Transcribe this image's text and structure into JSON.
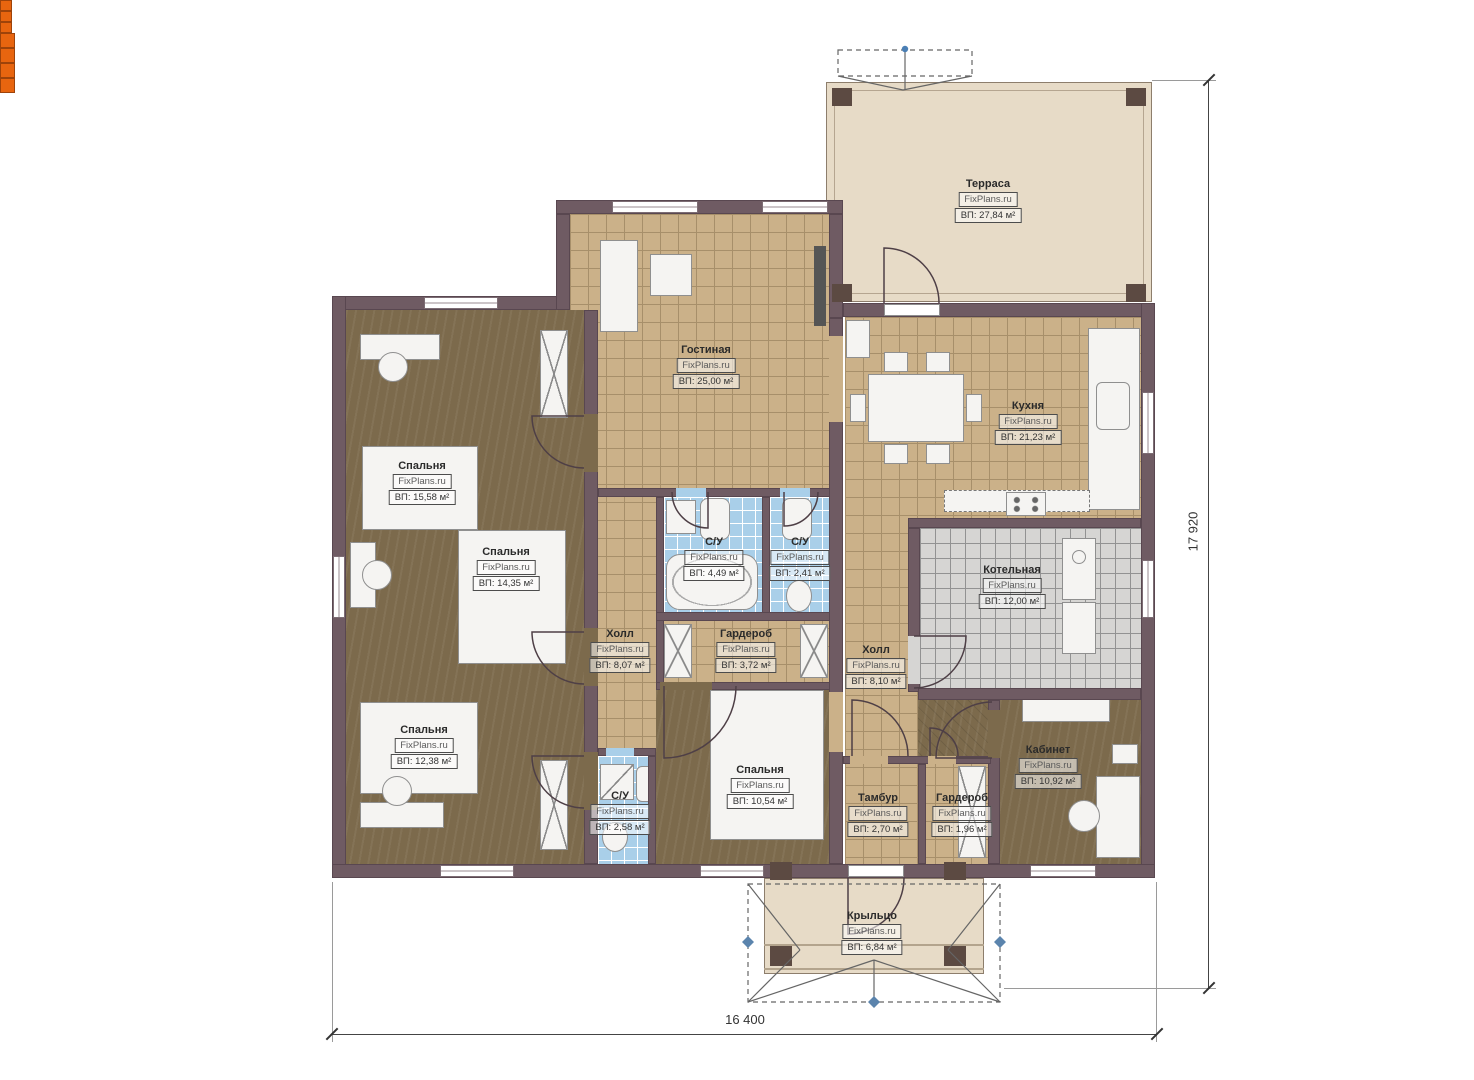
{
  "plan": {
    "brand": "FixPlans.ru",
    "dims": {
      "width": "16 400",
      "height": "17 920"
    },
    "rooms": [
      {
        "name": "Терраса",
        "area": "ВП: 27,84 м²"
      },
      {
        "name": "Гостиная",
        "area": "ВП: 25,00 м²"
      },
      {
        "name": "Кухня",
        "area": "ВП: 21,23 м²"
      },
      {
        "name": "Спальня",
        "area": "ВП: 15,58 м²"
      },
      {
        "name": "Спальня",
        "area": "ВП: 14,35 м²"
      },
      {
        "name": "С/У",
        "area": "ВП: 4,49 м²"
      },
      {
        "name": "С/У",
        "area": "ВП: 2,41 м²"
      },
      {
        "name": "Котельная",
        "area": "ВП: 12,00 м²"
      },
      {
        "name": "Холл",
        "area": "ВП: 8,07 м²"
      },
      {
        "name": "Гардероб",
        "area": "ВП: 3,72 м²"
      },
      {
        "name": "Холл",
        "area": "ВП: 8,10 м²"
      },
      {
        "name": "Спальня",
        "area": "ВП: 12,38 м²"
      },
      {
        "name": "Кабинет",
        "area": "ВП: 10,92 м²"
      },
      {
        "name": "С/У",
        "area": "ВП: 2,58 м²"
      },
      {
        "name": "Спальня",
        "area": "ВП: 10,54 м²"
      },
      {
        "name": "Тамбур",
        "area": "ВП: 2,70 м²"
      },
      {
        "name": "Гардероб",
        "area": "ВП: 1,96 м²"
      },
      {
        "name": "Крыльцо",
        "area": "ВП: 6,84 м²"
      }
    ],
    "colors": {
      "wall": "#6f5b63",
      "tile_tan": "#cbb189",
      "wood_brown": "#7c6a4c",
      "tile_blue": "#a9cfe9",
      "tile_gray": "#d6d5d3",
      "terrace": "#e7dbc7",
      "accent_orange": "#e8650f",
      "dimension": "#333333"
    }
  }
}
